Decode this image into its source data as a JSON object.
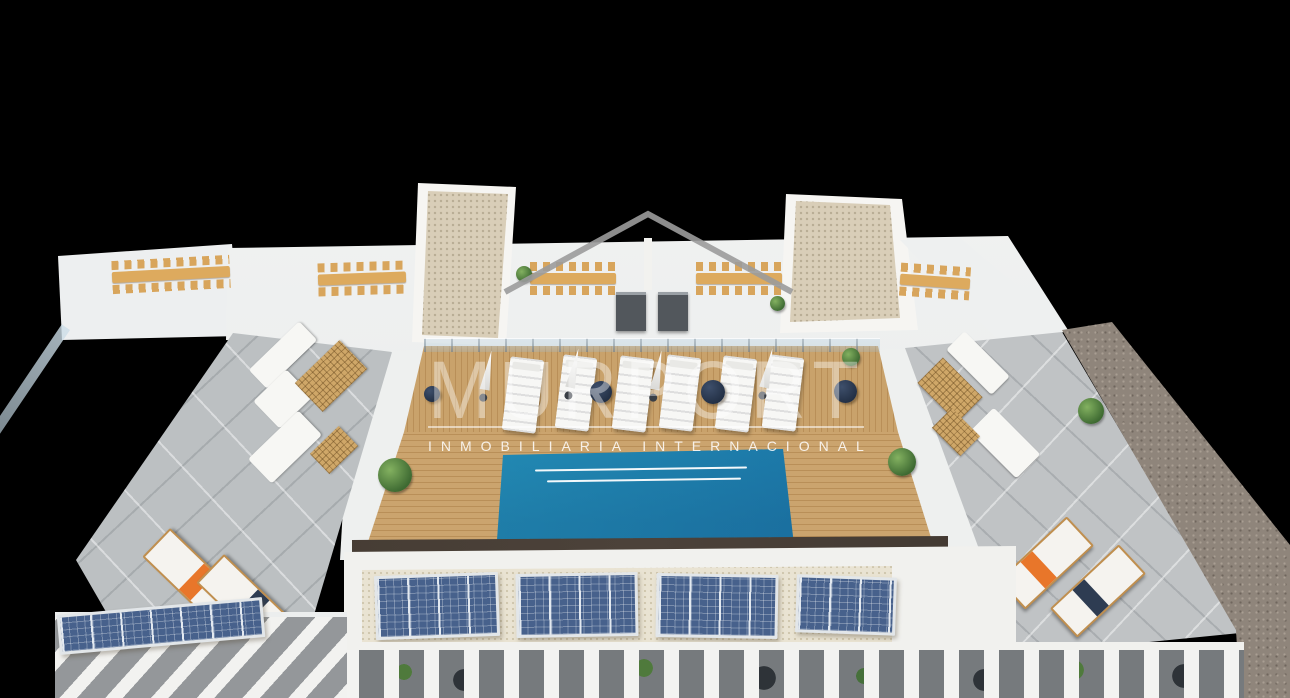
{
  "watermark": {
    "brand": "MURPORT",
    "tagline": "INMOBILIARIA INTERNACIONAL",
    "logo": "roof-outline-icon"
  },
  "scene": {
    "type": "aerial-3d-architectural-render",
    "subject": "rooftop solarium with swimming pool, wooden deck, sun loungers, parasols, dining pergolas, lounge terraces and solar panels",
    "background": "#000000"
  },
  "colors": {
    "pool_light": "#3cc0de",
    "pool_dark": "#1f6fa6",
    "deck_wood": "#c9a26b",
    "terrace_concrete": "#bcc0c2",
    "solar_panel_blue": "#47618c",
    "towel_orange": "#e8762a",
    "pouf_navy": "#2e3c52",
    "gravel_wall": "#8f857b",
    "watermark_white": "#ffffff"
  }
}
